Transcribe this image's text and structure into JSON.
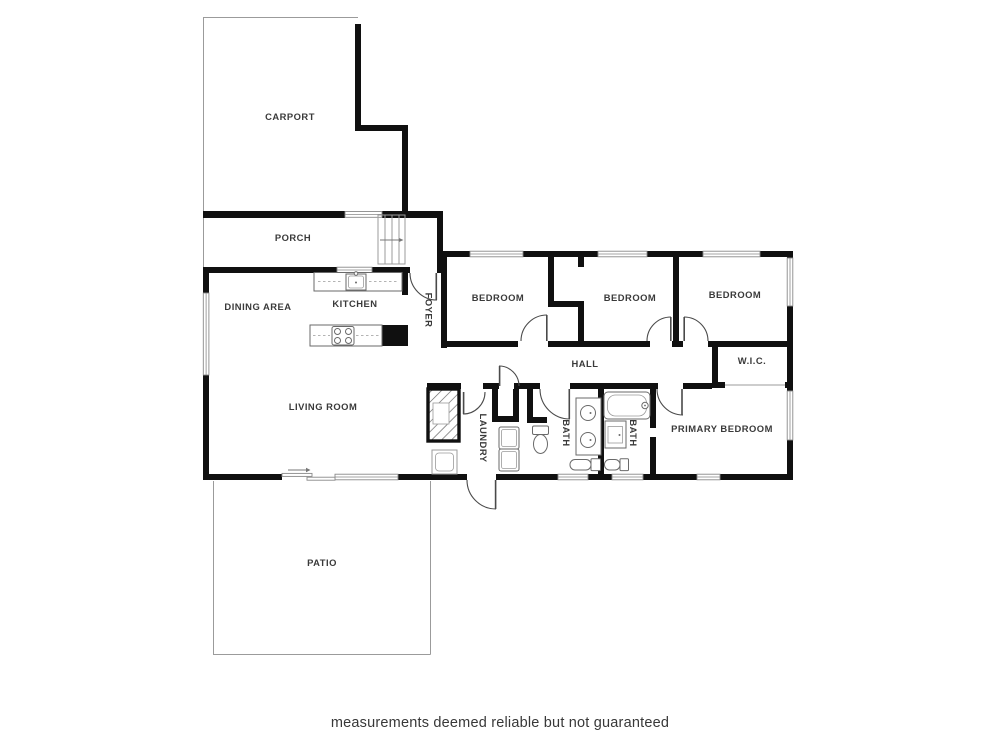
{
  "rooms": {
    "carport": "CARPORT",
    "porch": "PORCH",
    "dining_area": "DINING AREA",
    "kitchen": "KITCHEN",
    "foyer": "FOYER",
    "living_room": "LIVING ROOM",
    "bedroom_1": "BEDROOM",
    "bedroom_2": "BEDROOM",
    "bedroom_3": "BEDROOM",
    "hall": "HALL",
    "wic": "W.I.C.",
    "laundry": "LAUNDRY",
    "bath_1": "BATH",
    "bath_2": "BATH",
    "primary_bedroom": "PRIMARY BEDROOM",
    "patio": "PATIO"
  },
  "footer": {
    "disclaimer": "measurements deemed reliable but not guaranteed"
  },
  "colors": {
    "wall": "#101010",
    "thin_line": "#9b9b9b",
    "door": "#4a4a4a",
    "fixture": "#6a6a6a",
    "label": "#3a3a3a",
    "background": "#ffffff"
  }
}
